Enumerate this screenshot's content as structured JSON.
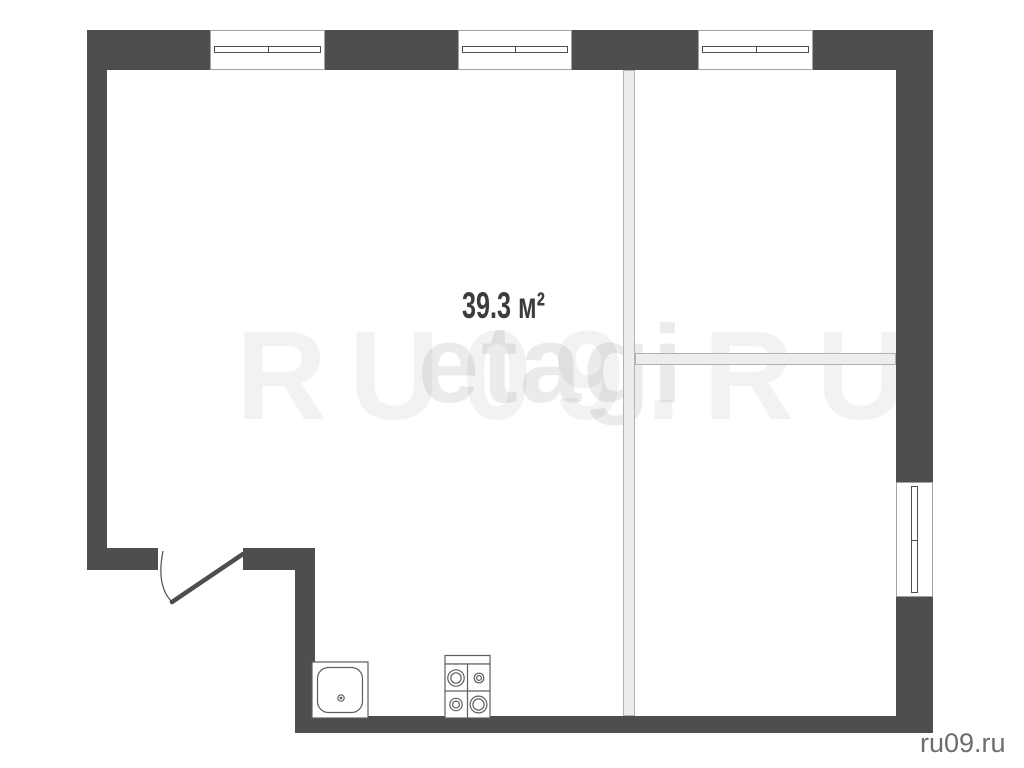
{
  "floorplan": {
    "type": "apartment-floor-plan",
    "area_label": "39.3 м²",
    "main_room_area_sqm": 39.3,
    "fixtures": [
      {
        "name": "window",
        "location": "top-wall-left"
      },
      {
        "name": "window",
        "location": "top-wall-center"
      },
      {
        "name": "window",
        "location": "top-wall-right"
      },
      {
        "name": "window",
        "location": "right-wall"
      },
      {
        "name": "door-swing",
        "location": "bottom-left"
      },
      {
        "name": "kitchen-sink",
        "location": "bottom"
      },
      {
        "name": "stove-4-burner",
        "location": "bottom"
      }
    ]
  },
  "watermarks": {
    "large": "RU09.RU",
    "logo": "etagi",
    "site": "ru09.ru"
  },
  "colors": {
    "wall": "#4e4e4e",
    "interior_wall_fill": "#ededed",
    "interior_wall_border": "#b2b2b2",
    "window_frame_border": "#a3a3a3",
    "fixture_stroke": "#5f5f5f",
    "area_label": "#3c3c3c",
    "site_label": "#6e6e6e",
    "watermark_large": "rgba(0,0,0,0.05)",
    "watermark_logo": "rgba(0,0,0,0.08)",
    "background": "#ffffff"
  }
}
